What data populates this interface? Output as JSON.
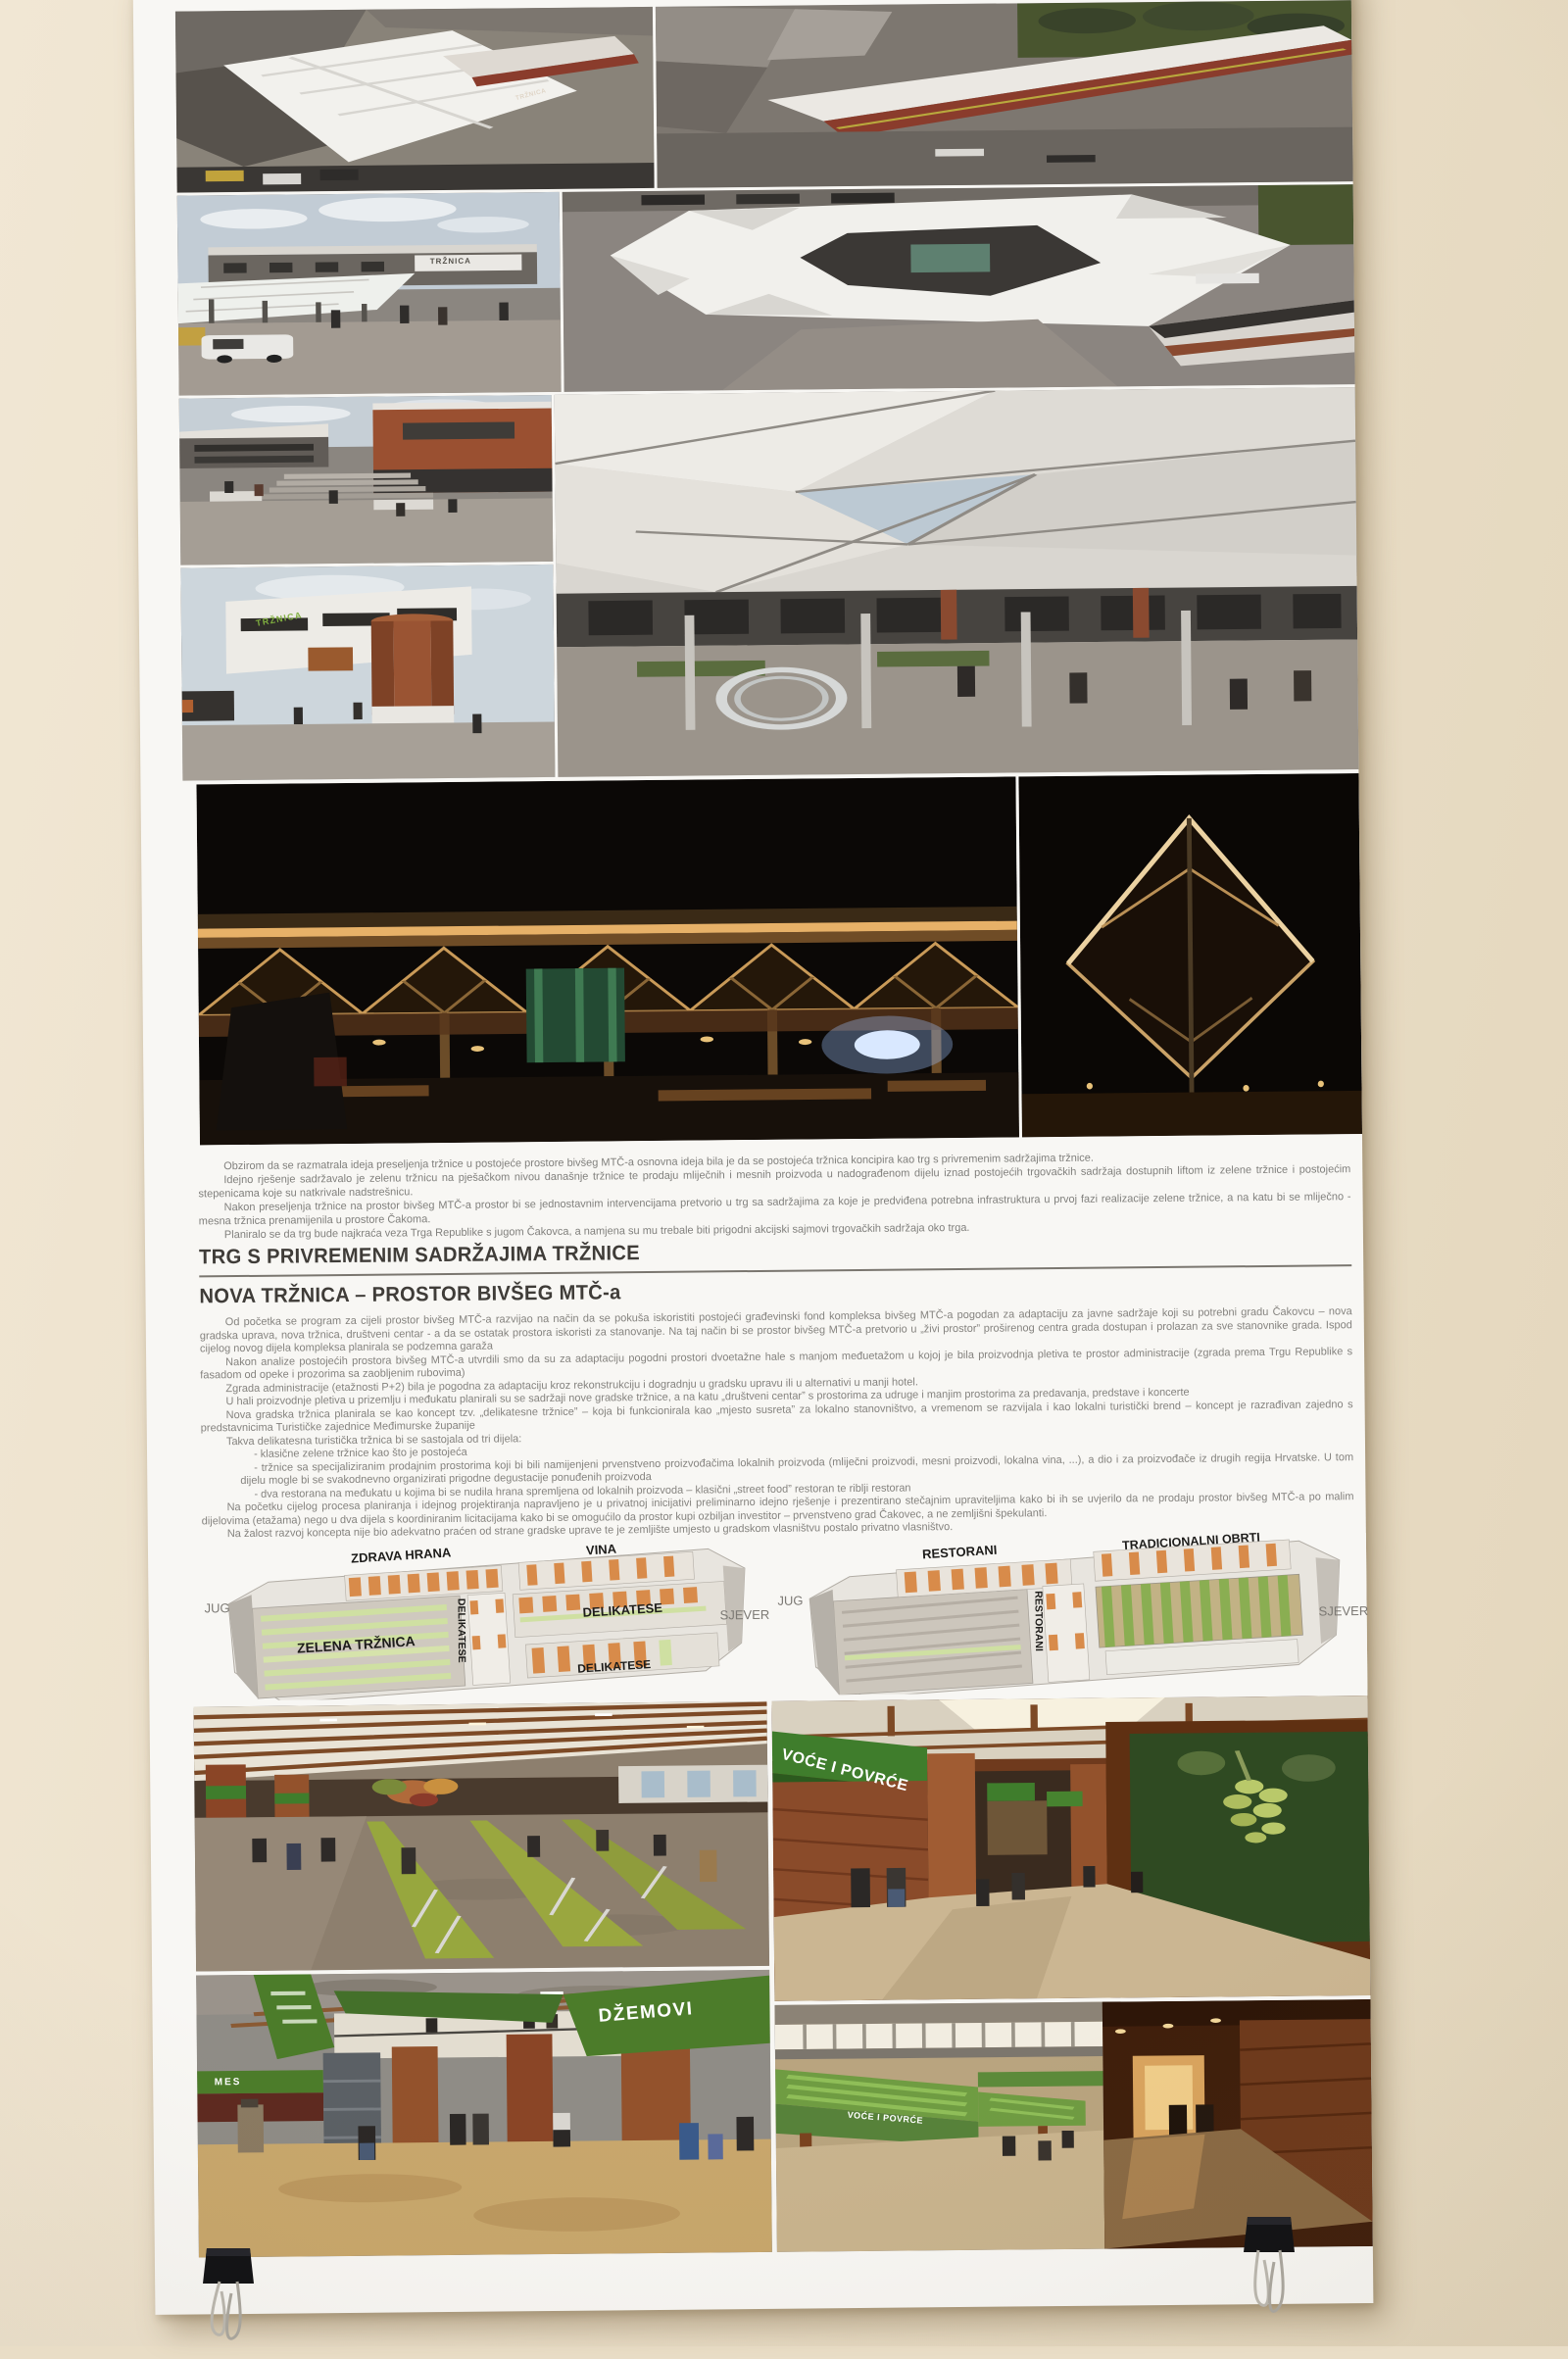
{
  "colors": {
    "wall": "#ebdfc9",
    "paper": "#f8f7f4",
    "sign_green": "#3f7d2c",
    "brick": "#8a4b2a",
    "night_amber": "#c89a58",
    "plan_orange": "#d88b4a"
  },
  "poster": {
    "intro": {
      "paragraphs": [
        "Obzirom da se razmatrala ideja preseljenja tržnice u postojeće prostore bivšeg MTČ-a osnovna ideja bila je da se postojeća tržnica koncipira kao trg s privremenim sadržajima tržnice.",
        "Idejno rješenje sadržavalo je zelenu tržnicu na pješačkom nivou današnje tržnice te prodaju mliječnih i mesnih proizvoda u nadograđenom dijelu iznad postojećih trgovačkih sadržaja dostupnih liftom iz zelene tržnice i postojećim stepenicama koje su natkrivale nadstrešnicu.",
        "Nakon preseljenja tržnice na prostor bivšeg MTČ-a prostor bi se jednostavnim intervencijama pretvorio u trg sa sadržajima za koje je predviđena potrebna infrastruktura u prvoj fazi realizacije zelene tržnice, a na katu bi se mliječno - mesna tržnica prenamijenila u prostore Čakoma.",
        "Planiralo se da trg bude najkraća veza Trga Republike s jugom Čakovca, a namjena su mu trebale biti prigodni akcijski sajmovi trgovačkih sadržaja oko trga."
      ]
    },
    "section1_title": "TRG S PRIVREMENIM SADRŽAJIMA TRŽNICE",
    "section2_title": "NOVA TRŽNICA – PROSTOR BIVŠEG MTČ-a",
    "body": {
      "paragraphs": [
        "Od početka se program za cijeli prostor bivšeg MTČ-a razvijao na način da se pokuša iskoristiti postojeći građevinski fond kompleksa bivšeg MTČ-a pogodan za adaptaciju za javne sadržaje koji su potrebni gradu Čakovcu – nova gradska uprava, nova tržnica, društveni centar - a da se ostatak prostora iskoristi za stanovanje. Na taj način bi se prostor bivšeg MTČ-a pretvorio u „živi prostor” proširenog centra grada dostupan i prolazan za sve stanovnike grada. Ispod cijelog novog dijela kompleksa planirala se podzemna garaža",
        "Nakon analize postojećih prostora bivšeg MTČ-a utvrdili smo da su za adaptaciju pogodni prostori dvoetažne hale s manjom međuetažom u kojoj je bila proizvodnja pletiva te prostor administracije (zgrada prema Trgu Republike s fasadom od opeke i prozorima sa zaobljenim rubovima)",
        "Zgrada administracije (etažnosti P+2) bila je pogodna za adaptaciju kroz rekonstrukciju i dogradnju u gradsku upravu ili u alternativi u manji hotel.",
        "U hali proizvodnje pletiva u prizemlju i međukatu planirali su se sadržaji nove gradske tržnice, a na katu „društveni centar” s prostorima za udruge i manjim prostorima za predavanja, predstave i koncerte",
        "Nova gradska tržnica planirala se kao koncept tzv. „delikatesne tržnice” – koja bi funkcionirala kao „mjesto susreta” za lokalno stanovništvo, a vremenom se razvijala i kao lokalni turistički brend – koncept je razrađivan zajedno s predstavnicima Turističke zajednice Međimurske županije",
        "Takva delikatesna turistička tržnica bi se sastojala od tri dijela:",
        "- klasične zelene tržnice kao što je postojeća",
        "- tržnice sa specijaliziranim prodajnim prostorima koji bi bili namijenjeni prvenstveno proizvođačima lokalnih proizvoda (mliječni proizvodi, mesni proizvodi, lokalna vina, ...), a dio i za proizvođače iz drugih regija Hrvatske. U tom dijelu mogle bi se svakodnevno organizirati prigodne degustacije ponuđenih proizvoda",
        "- dva restorana na međukatu u kojima bi se nudila hrana spremljena od lokalnih proizvoda – klasični „street food” restoran te riblji restoran",
        "Na početku cijelog procesa planiranja i idejnog projektiranja napravljeno je u privatnoj inicijativi preliminarno idejno rješenje i prezentirano stečajnim upraviteljima kako bi ih se uvjerilo da ne prodaju prostor bivšeg MTČ-a po malim dijelovima (etažama) nego u dva dijela s koordiniranim licitacijama kako bi se omogućilo da prostor kupi ozbiljan investitor – prvenstveno grad Čakovec, a ne zemljišni špekulanti.",
        "Na žalost razvoj koncepta nije bio adekvatno praćen od strane gradske uprave te je zemljište umjesto u gradskom vlasništvu postalo privatno vlasništvo."
      ]
    },
    "plans": {
      "left": {
        "jug": "JUG",
        "sjever": "SJEVER",
        "zdrava_hrana": "ZDRAVA HRANA",
        "vina": "VINA",
        "delikatese_vertical": "DELIKATESE",
        "delikatese_mid": "DELIKATESE",
        "delikatese_low": "DELIKATESE",
        "zelena_trznica": "ZELENA TRŽNICA"
      },
      "right": {
        "jug": "JUG",
        "sjever": "SJEVER",
        "restorani_top": "RESTORANI",
        "tradicionalni_obrti": "TRADICIONALNI OBRTI",
        "restorani_vertical": "RESTORANI"
      }
    },
    "render_signs": {
      "trznica_round": "TRŽNICA",
      "trznica_facade": "TRŽNICA",
      "trznica_green": "TRŽNICA",
      "voce_povrce_corridor": "VOĆE I POVRĆE",
      "dzemovi": "DŽEMOVI",
      "mes": "MES",
      "voce_povrce_stalls": "VOĆE I POVRĆE"
    }
  }
}
